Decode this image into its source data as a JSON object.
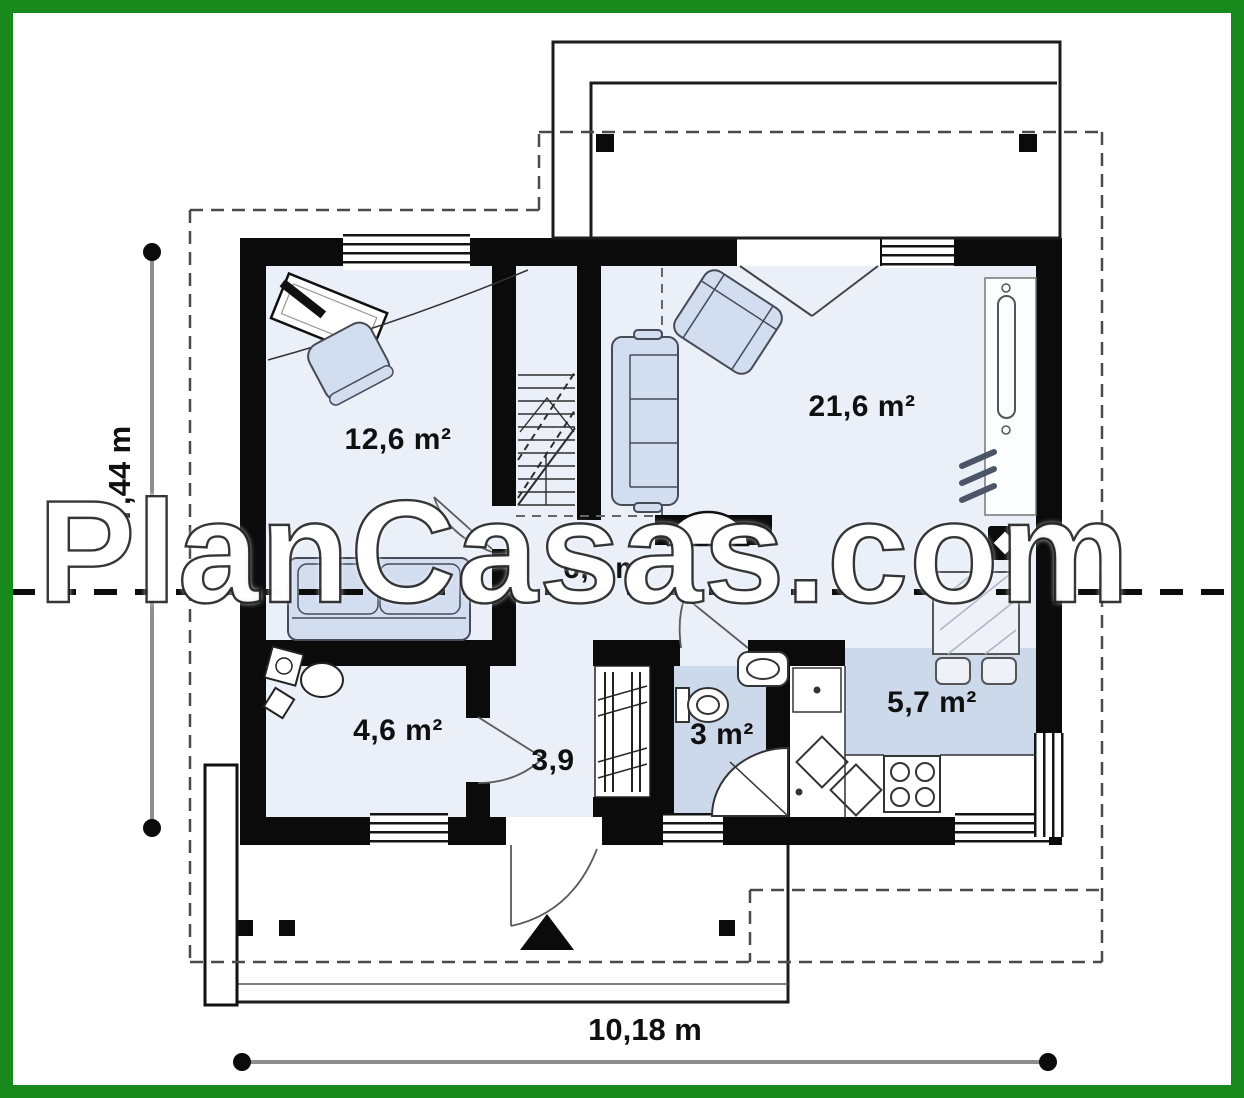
{
  "watermark": "PlanCasas.com",
  "plan": {
    "rooms": [
      {
        "name": "bedroom",
        "label": "12,6 m²"
      },
      {
        "name": "living-room",
        "label": "21,6 m²"
      },
      {
        "name": "hall",
        "label": "6,9 m²"
      },
      {
        "name": "utility-room",
        "label": "4,6 m²"
      },
      {
        "name": "corridor",
        "label": "3,9"
      },
      {
        "name": "bathroom",
        "label": "3 m²"
      },
      {
        "name": "kitchen",
        "label": "5,7 m²"
      }
    ],
    "dimensions": {
      "total_width": "10,18 m",
      "total_height": "7,44 m"
    },
    "colors": {
      "frame_green": "#18891c",
      "wall_black": "#0b0b0b",
      "floor_light": "#eaeff8",
      "floor_accent": "#ccd9eb",
      "furniture_fill": "#d3ddf0"
    }
  }
}
